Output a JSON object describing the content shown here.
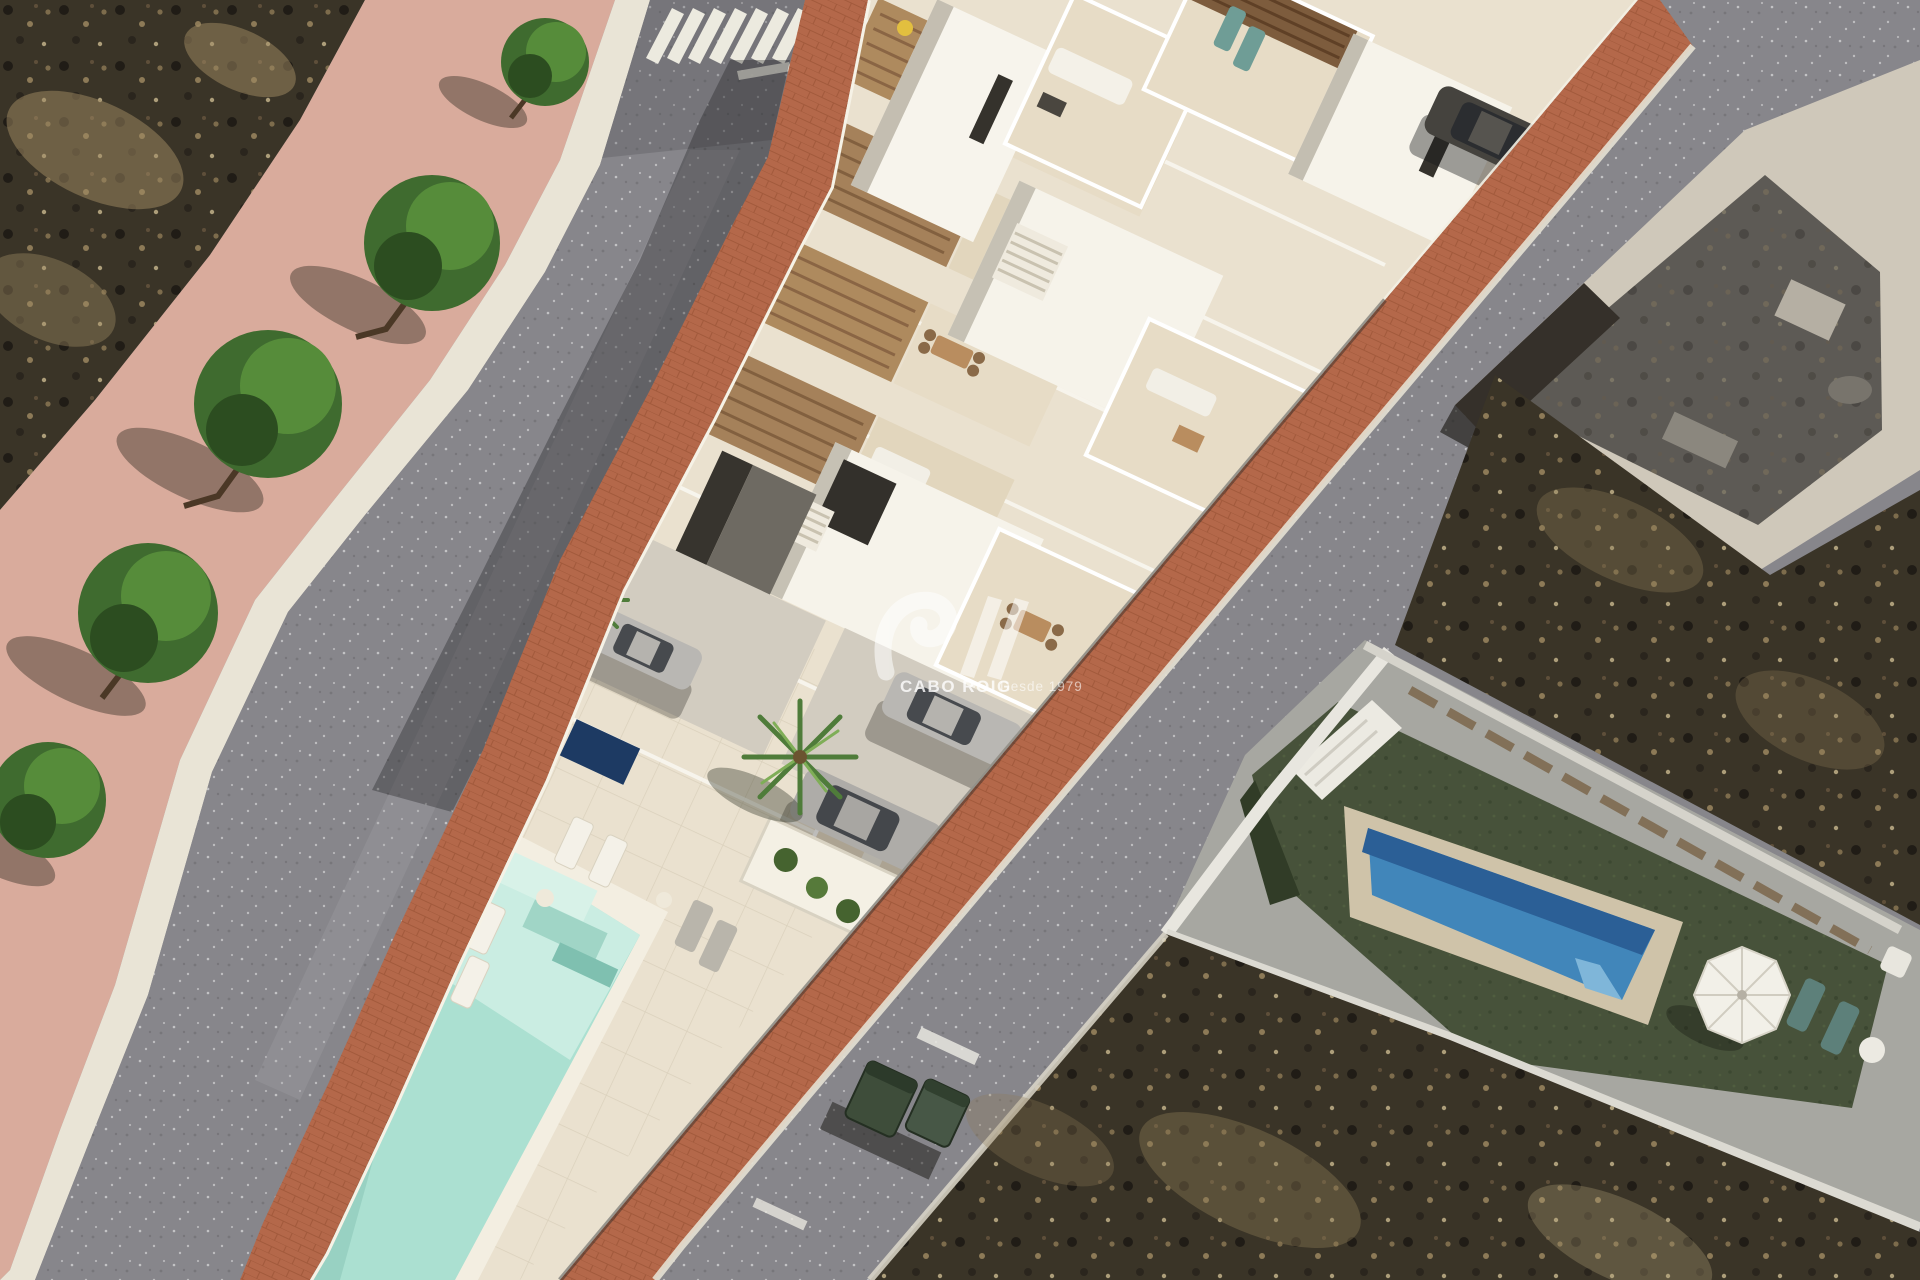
{
  "watermark": {
    "logo": "siv-swoosh-monogram",
    "brand": "CABO ROIG",
    "tagline": "Desde 1979"
  },
  "scene": {
    "type": "aerial 3D architectural render",
    "subject": "New-build terraced townhouse development with roof terraces, driveways and a communal wedge-shaped pool, beside an existing villa street",
    "features": [
      "zebra crosswalk at street junction",
      "tree-lined pink sidewalk",
      "asphalt streets with speckled texture",
      "terracotta paver sidewalk strips on both sides of the development",
      "white townhouses with wooden pergola roof terraces",
      "outdoor lounge and dining furniture on terraces",
      "external staircases",
      "driveways with parked silver cars and one dark car",
      "small private plunge pools",
      "palm trees and planters",
      "communal turquoise swimming pool with steps",
      "white sun loungers on paved deck",
      "neighbouring villa with artificial lawn, blue pool and white parasol",
      "existing flat-roof building at top right",
      "dry brown scrubland plots",
      "green wheelie bins at the kerb"
    ]
  },
  "colors": {
    "road": "#87868b",
    "roadLight": "#9b9aa0",
    "sidewalkPink": "#d9ab9c",
    "curb": "#e9e4d6",
    "scrub": "#3a3427",
    "scrubLight": "#a18c63",
    "brick": "#b4684a",
    "plaster": "#eae1cf",
    "terrace": "#e7dcc6",
    "wallWhite": "#f7f4ec",
    "wallShade": "#b6b0a2",
    "pergolaWood": "#ae8a5e",
    "poolMint": "#abe0d1",
    "poolMintLight": "#cdeee3",
    "poolBlue": "#4186ba",
    "poolBlueDark": "#2b5f96",
    "poolBorder": "#cfc3a9",
    "lawn": "#47523a",
    "carSilver": "#b9b7b3",
    "carDark": "#45433e",
    "teal": "#6f9d96",
    "bin": "#3e4d3a",
    "parasol": "#f2f0e8",
    "treeGreen": "#3f6b2f",
    "palmGreen": "#4f7c3a",
    "watermark": "#ffffff"
  }
}
